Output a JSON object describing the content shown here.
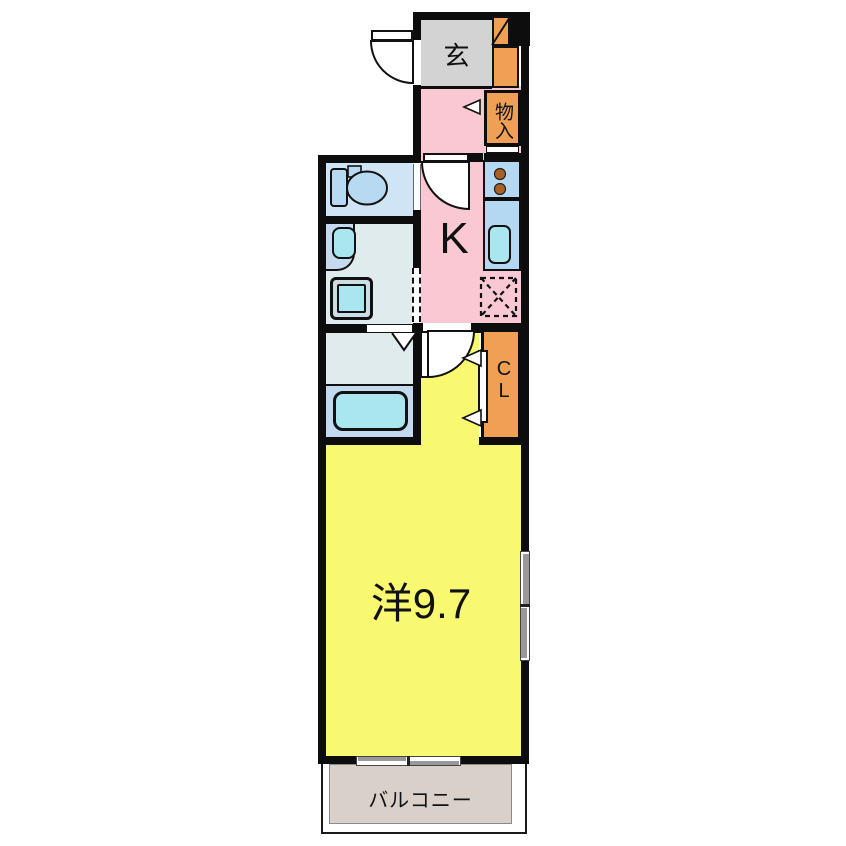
{
  "floorplan": {
    "type": "japanese-apartment-floor-plan",
    "rooms": {
      "genkan": {
        "label": "玄"
      },
      "storage": {
        "label": "物入"
      },
      "kitchen": {
        "label": "K"
      },
      "closet": {
        "label": "CL"
      },
      "western_room": {
        "label": "洋9.7"
      },
      "balcony": {
        "label": "バルコニー"
      }
    },
    "colors": {
      "wall": "#0d0d0d",
      "genkan_floor": "#d3d3d3",
      "kitchen_floor": "#f9c8d3",
      "room_floor": "#f9f871",
      "wet_area_floor": "#e0ebee",
      "toilet_floor": "#cfe5f5",
      "bath_floor": "#c3d9f0",
      "fixture_cyan": "#a9e6f0",
      "counter_blue": "#b5d8f2",
      "storage_orange": "#f0a055",
      "burner_brown": "#a96025",
      "balcony_floor": "#d9d1c9"
    }
  }
}
